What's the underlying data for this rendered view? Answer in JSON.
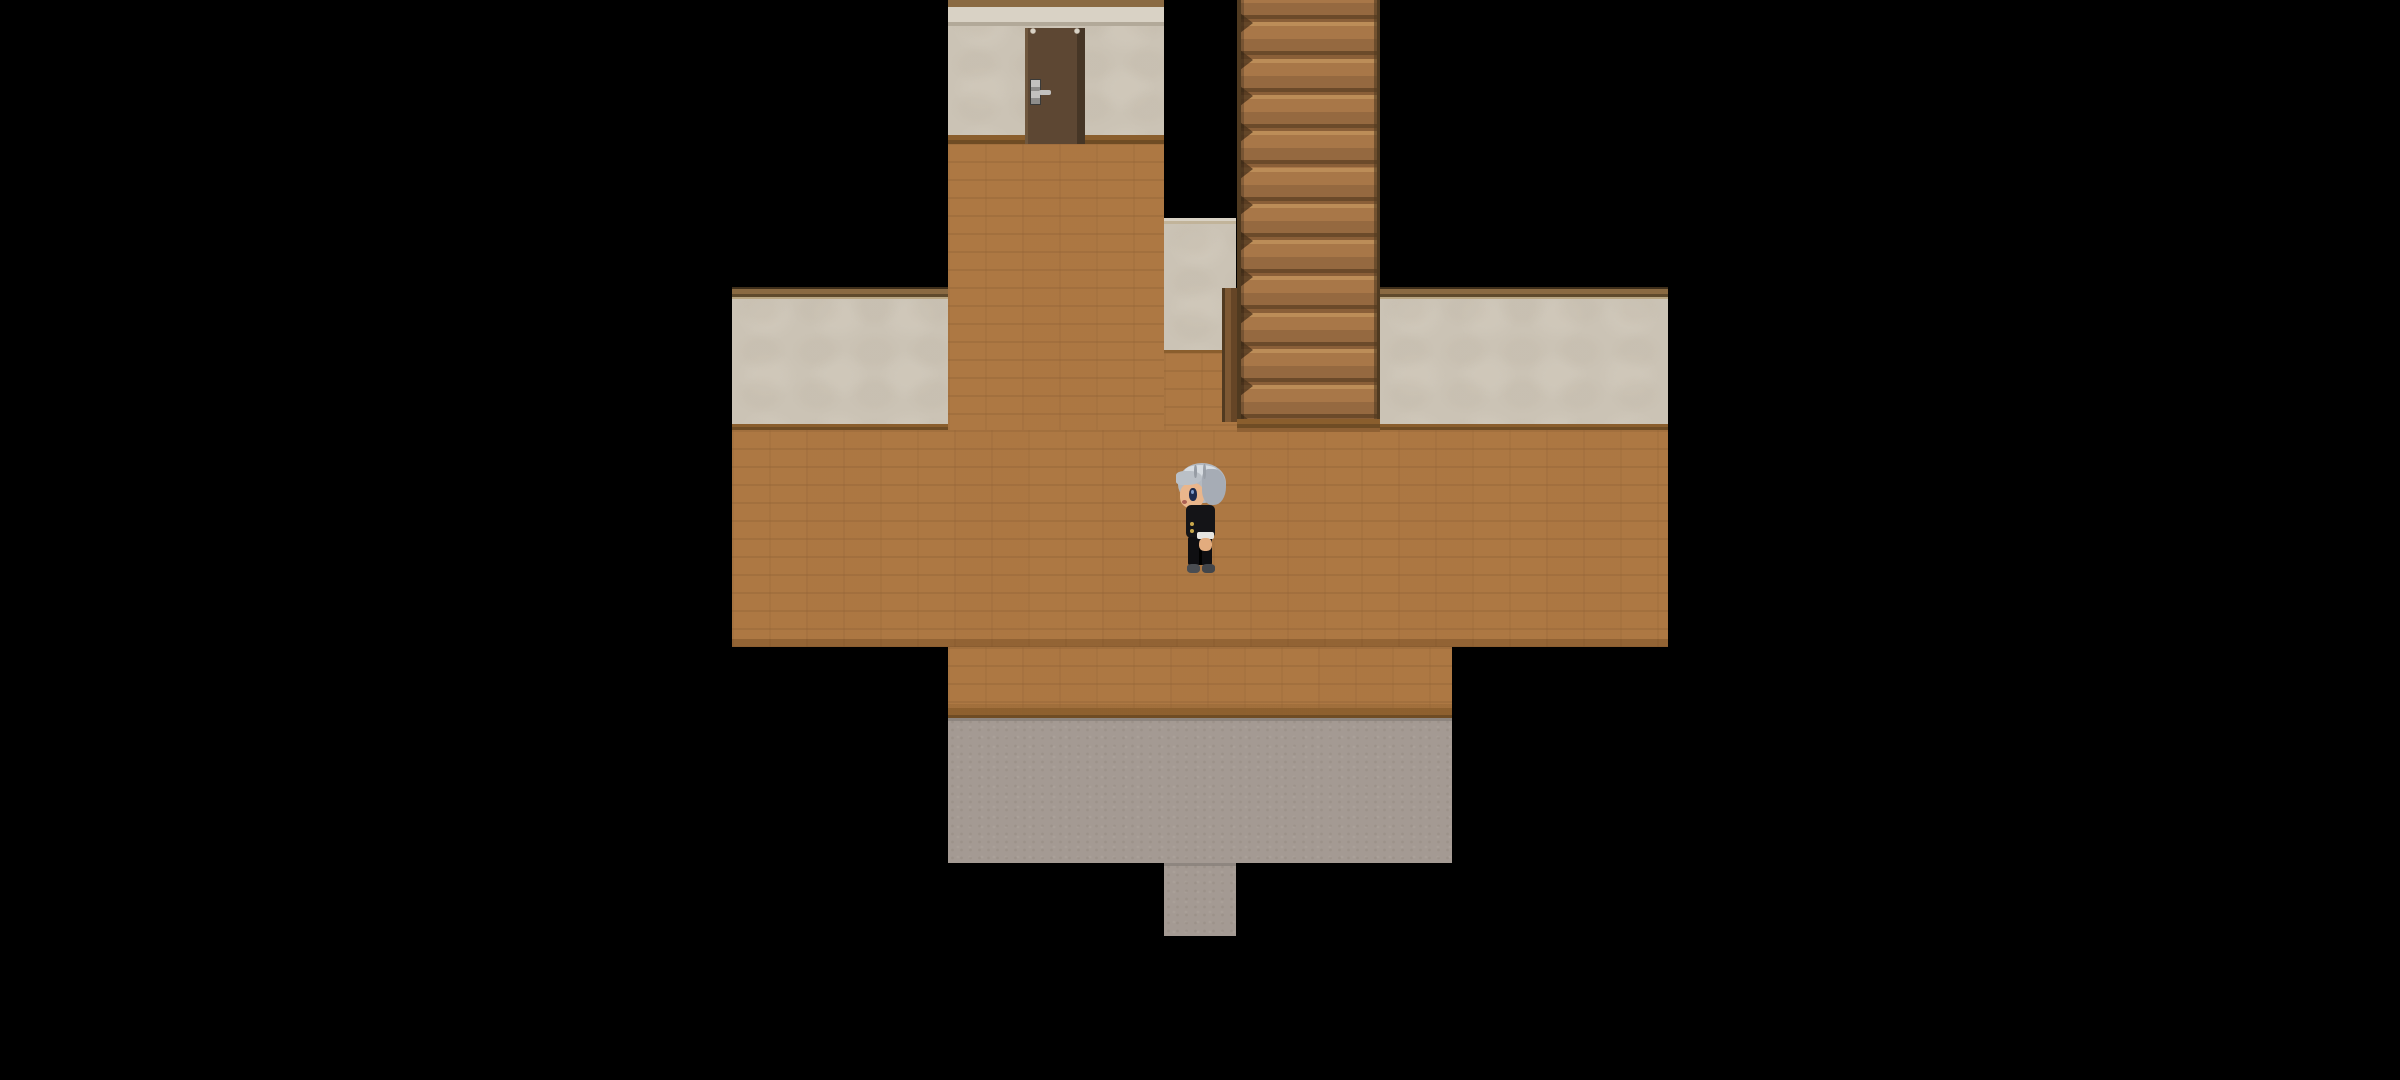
{
  "meta": {
    "app_type": "rpg-game-viewport",
    "scene_name": "wooden-hallway-with-stairs",
    "visible_text": "none",
    "hud": "none"
  },
  "scene": {
    "width": 2400,
    "height": 1080,
    "background": "#000000",
    "tile_size": 72
  },
  "palette": {
    "black": "#000000",
    "wood": "#ad7843",
    "wood_mortar": "#8f6134",
    "wood_alt": "#a37040",
    "board_mid": "#8a5e2d",
    "board_dark": "#6f4c24",
    "wall": "#cbc3b5",
    "wall_shade": "#bfb5a5",
    "wall_light": "#d8d1c4",
    "cap_dark": "#3f2f1b",
    "cap_mid": "#8a6a42",
    "cap_shadow": "#5f4a2c",
    "cap_light": "#b9a682",
    "cream": "#d9d2c5",
    "cream_line": "#b2a999",
    "stone": "#a49a93",
    "stone_dark": "#8d8279",
    "stone_light": "#b5aca4",
    "door": "#5d4733",
    "door_light": "#6f573e",
    "door_dark": "#463626",
    "handle": "#c2c1bf",
    "handle_dark": "#8e8d8b",
    "stair_tread": "#a87748",
    "stair_hl": "#bc8d58",
    "stair_mid": "#956940",
    "stair_shadow": "#6b4a2a",
    "stair_riser": "#8a5f38",
    "stair_edge": "#503a20"
  },
  "stairs_config": {
    "step_height": 36.3,
    "first_boundary_offset": -14,
    "step_count": 13
  },
  "elements": [
    {
      "name": "hall-column-floor",
      "kind": "wood",
      "interactable": "true",
      "x": 948,
      "y": 143,
      "w": 216,
      "h": 288
    },
    {
      "name": "floor-patch-under-stair-wall",
      "kind": "wood",
      "interactable": "true",
      "x": 1164,
      "y": 352,
      "w": 73,
      "h": 79
    },
    {
      "name": "main-floor",
      "kind": "wood-main",
      "interactable": "true",
      "x": 732,
      "y": 430,
      "w": 936,
      "h": 217
    },
    {
      "name": "lower-floor",
      "kind": "wood-lower",
      "interactable": "true",
      "x": 948,
      "y": 647,
      "w": 504,
      "h": 73
    },
    {
      "name": "stone-floor",
      "kind": "stone",
      "interactable": "true",
      "x": 948,
      "y": 718,
      "w": 504,
      "h": 145
    },
    {
      "name": "stone-exit-corridor",
      "kind": "stone",
      "interactable": "true",
      "x": 1164,
      "y": 863,
      "w": 72,
      "h": 73
    },
    {
      "name": "top-wall-with-door",
      "kind": "door-wall",
      "interactable": "false",
      "x": 948,
      "y": 0,
      "w": 216,
      "h": 144
    },
    {
      "name": "door",
      "kind": "door",
      "interactable": "true",
      "x": 1025,
      "y": 28,
      "w": 60,
      "h": 116
    },
    {
      "name": "stair-side-wall",
      "kind": "small-wall",
      "interactable": "false",
      "x": 1164,
      "y": 218,
      "w": 72,
      "h": 135
    },
    {
      "name": "stair-stringer",
      "kind": "stringer",
      "interactable": "false",
      "x": 1222,
      "y": 288,
      "w": 15,
      "h": 134
    },
    {
      "name": "staircase",
      "kind": "stairs",
      "interactable": "true",
      "x": 1237,
      "y": 0,
      "w": 143,
      "h": 421
    },
    {
      "name": "understairs-strip",
      "kind": "strip",
      "interactable": "false",
      "x": 1237,
      "y": 419,
      "w": 143,
      "h": 13
    },
    {
      "name": "left-wall",
      "kind": "capped-wall",
      "interactable": "false",
      "x": 732,
      "y": 287,
      "w": 216,
      "h": 143
    },
    {
      "name": "right-wall",
      "kind": "capped-wall",
      "interactable": "false",
      "x": 1380,
      "y": 287,
      "w": 288,
      "h": 143
    }
  ],
  "player": {
    "name": "player-character",
    "facing": "left",
    "interactable": "false",
    "x": 1176,
    "y": 463,
    "w": 52,
    "h": 110,
    "rects": [
      {
        "n": "player-hair-back",
        "x": 2,
        "y": 0,
        "w": 48,
        "h": 40,
        "c": "#b3b9c1",
        "r": "50% 50% 46% 46%"
      },
      {
        "n": "player-hair-shine",
        "x": 8,
        "y": 2,
        "w": 34,
        "h": 13,
        "c": "#d7dce1",
        "r": "50%"
      },
      {
        "n": "player-face",
        "x": 4,
        "y": 20,
        "w": 24,
        "h": 25,
        "c": "#e9b68c",
        "r": "42%"
      },
      {
        "n": "player-hair-fringe",
        "x": 0,
        "y": 8,
        "w": 26,
        "h": 14,
        "c": "#bac0c7",
        "r": "40% 60% 70% 30%"
      },
      {
        "n": "player-hair-side",
        "x": 26,
        "y": 6,
        "w": 24,
        "h": 36,
        "c": "#a6acb5",
        "r": "30% 55% 55% 45%"
      },
      {
        "n": "player-hair-strand",
        "x": 18,
        "y": 2,
        "w": 3,
        "h": 13,
        "c": "#969ca4",
        "r": "40%"
      },
      {
        "n": "player-hair-strand",
        "x": 27,
        "y": 1,
        "w": 3,
        "h": 15,
        "c": "#9aa0a8",
        "r": "40%"
      },
      {
        "n": "player-eye",
        "x": 13,
        "y": 25,
        "w": 8,
        "h": 13,
        "c": "#1d2b4e",
        "r": "45%"
      },
      {
        "n": "player-eye-glint",
        "x": 15,
        "y": 27,
        "w": 3,
        "h": 4,
        "c": "#7f9cc9",
        "r": "50%"
      },
      {
        "n": "player-mouth",
        "x": 6,
        "y": 37,
        "w": 5,
        "h": 4,
        "c": "#a95f52",
        "r": "50%"
      },
      {
        "n": "player-jacket",
        "x": 10,
        "y": 42,
        "w": 29,
        "h": 33,
        "c": "#141417",
        "r": "5px"
      },
      {
        "n": "player-button",
        "x": 14,
        "y": 59,
        "w": 4,
        "h": 4,
        "c": "#c9a84c",
        "r": "50%"
      },
      {
        "n": "player-button",
        "x": 14,
        "y": 66,
        "w": 4,
        "h": 4,
        "c": "#c9a84c",
        "r": "50%"
      },
      {
        "n": "player-legs",
        "x": 12,
        "y": 74,
        "w": 24,
        "h": 28,
        "c": "#0f0f12",
        "r": "2px"
      },
      {
        "n": "player-leg-gap",
        "x": 23,
        "y": 84,
        "w": 3,
        "h": 18,
        "c": "#000000",
        "r": "0"
      },
      {
        "n": "player-cuff",
        "x": 21,
        "y": 69,
        "w": 17,
        "h": 7,
        "c": "#e6e5e1",
        "r": "2px"
      },
      {
        "n": "player-hand",
        "x": 23,
        "y": 75,
        "w": 13,
        "h": 13,
        "c": "#e3ac7e",
        "r": "40%"
      },
      {
        "n": "player-shoe",
        "x": 11,
        "y": 101,
        "w": 13,
        "h": 9,
        "c": "#4a4d52",
        "r": "35%"
      },
      {
        "n": "player-shoe",
        "x": 26,
        "y": 101,
        "w": 13,
        "h": 9,
        "c": "#42454a",
        "r": "35%"
      }
    ]
  }
}
